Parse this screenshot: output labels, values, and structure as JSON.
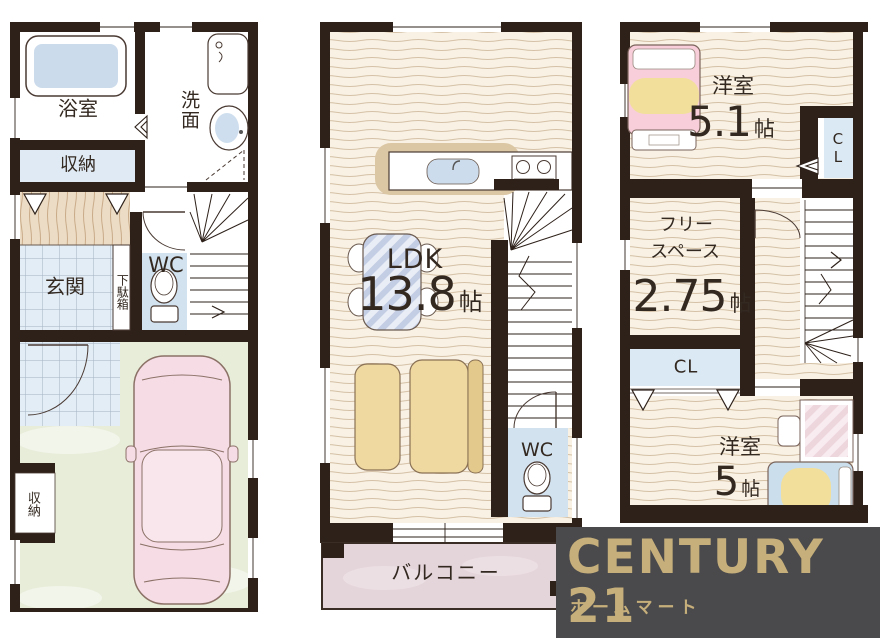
{
  "floor1": {
    "bath": "浴室",
    "washroom": "洗面",
    "storage_top": "収納",
    "entrance": "玄関",
    "shoe_cabinet": "下駄箱",
    "wc": "WC",
    "storage_bottom": "収納"
  },
  "floor2": {
    "ldk": "LDK",
    "ldk_size": "13.8",
    "ldk_unit": "帖",
    "wc": "WC",
    "balcony": "バルコニー"
  },
  "floor3": {
    "bedroom1": "洋室",
    "bedroom1_size": "5.1",
    "bedroom1_unit": "帖",
    "closet1": "CL",
    "free_line1": "フリー",
    "free_line2": "スペース",
    "free_size": "2.75",
    "free_unit": "帖",
    "closet2": "CL",
    "bedroom2": "洋室",
    "bedroom2_size": "5",
    "bedroom2_unit": "帖"
  },
  "logo": {
    "brand": "CENTURY 21",
    "subtitle": "ホームマート"
  },
  "colors": {
    "wall": "#2e211a",
    "wood_floor": "#f8f1e4",
    "hall_wood": "#ecdcc5",
    "tile_blue": "#e3edf6",
    "wc_floor": "#d2e2ef",
    "closet_blue": "#dbe9f5",
    "garage_green": "#e8edda",
    "balcony_pink": "#e4d5db",
    "car_pink": "#f5dce5",
    "bed_pink": "#f7ced9",
    "bed_blue": "#cadfeb",
    "blanket_yellow": "#f2df9b",
    "sofa_tan": "#efd9a1",
    "logo_bg": "#4a4a4c",
    "logo_gold": "#c6af7a"
  }
}
